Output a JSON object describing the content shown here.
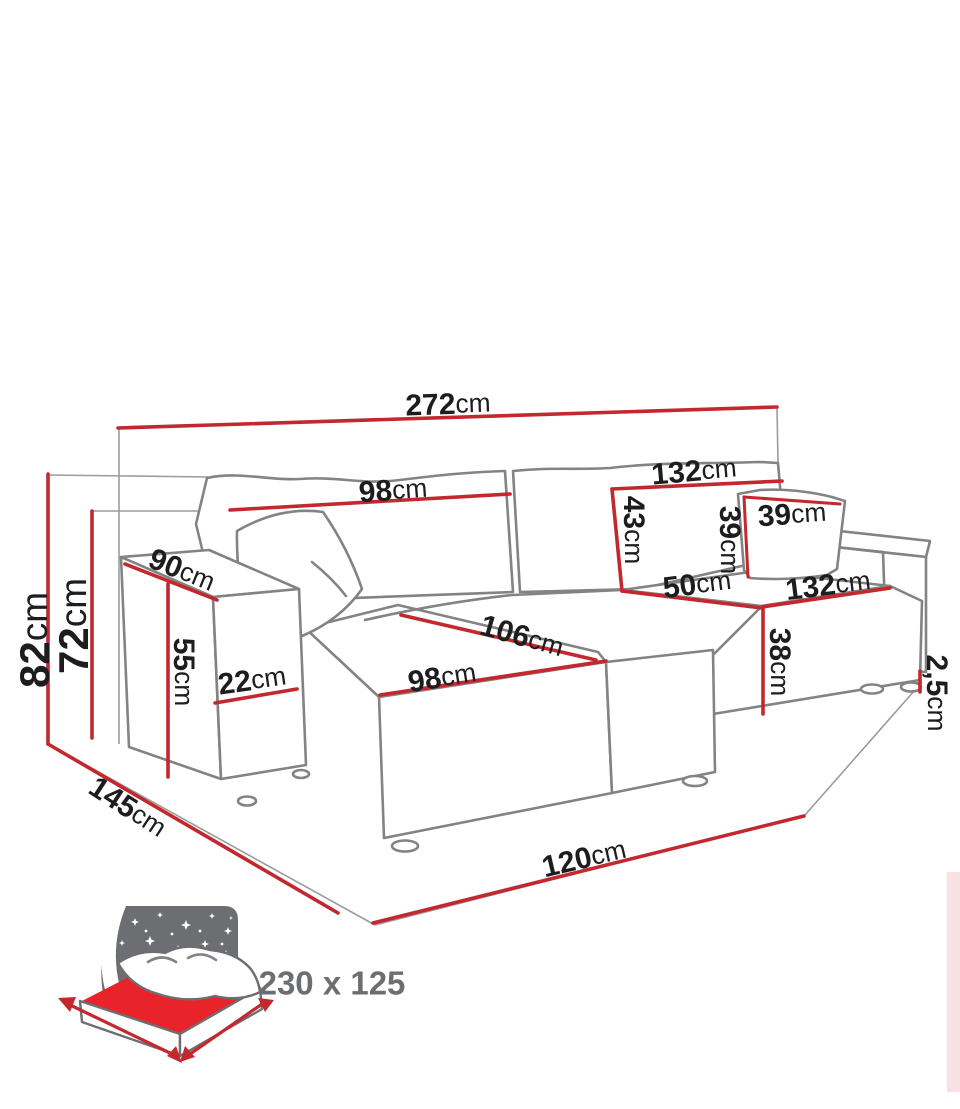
{
  "diagram": {
    "subject": "corner-sofa-dimension-diagram",
    "unit_suffix": "cm"
  },
  "colors": {
    "dimension_red": "#c2282e",
    "sofa_outline_gray": "#838383",
    "extension_gray": "#9c9c9c",
    "label_black": "#1d1d1f",
    "icon_gray": "#6d6e71",
    "mattress_red": "#e8232a",
    "edge_strip_pink": "#f8e0e4",
    "background": "#ffffff"
  },
  "dims": [
    {
      "id": "overall-width",
      "value": "272",
      "unit": "cm"
    },
    {
      "id": "back-right-width",
      "value": "132",
      "unit": "cm"
    },
    {
      "id": "back-left-width",
      "value": "98",
      "unit": "cm"
    },
    {
      "id": "backrest-height",
      "value": "43",
      "unit": "cm"
    },
    {
      "id": "cushion-width",
      "value": "39",
      "unit": "cm"
    },
    {
      "id": "cushion-height",
      "value": "39",
      "unit": "cm"
    },
    {
      "id": "seat-depth",
      "value": "50",
      "unit": "cm"
    },
    {
      "id": "right-seat-width",
      "value": "132",
      "unit": "cm"
    },
    {
      "id": "seat-height",
      "value": "38",
      "unit": "cm"
    },
    {
      "id": "base-clearance",
      "value": "2,5",
      "unit": "cm"
    },
    {
      "id": "chaise-length",
      "value": "106",
      "unit": "cm"
    },
    {
      "id": "chaise-width",
      "value": "98",
      "unit": "cm"
    },
    {
      "id": "armrest-depth",
      "value": "90",
      "unit": "cm"
    },
    {
      "id": "total-height",
      "value": "82",
      "unit": "cm"
    },
    {
      "id": "back-height",
      "value": "72",
      "unit": "cm"
    },
    {
      "id": "armrest-height",
      "value": "55",
      "unit": "cm"
    },
    {
      "id": "armrest-width",
      "value": "22",
      "unit": "cm"
    },
    {
      "id": "total-depth",
      "value": "145",
      "unit": "cm"
    },
    {
      "id": "front-width",
      "value": "120",
      "unit": "cm"
    }
  ],
  "bed_icon": {
    "sleeping_area": "230 x 125"
  }
}
